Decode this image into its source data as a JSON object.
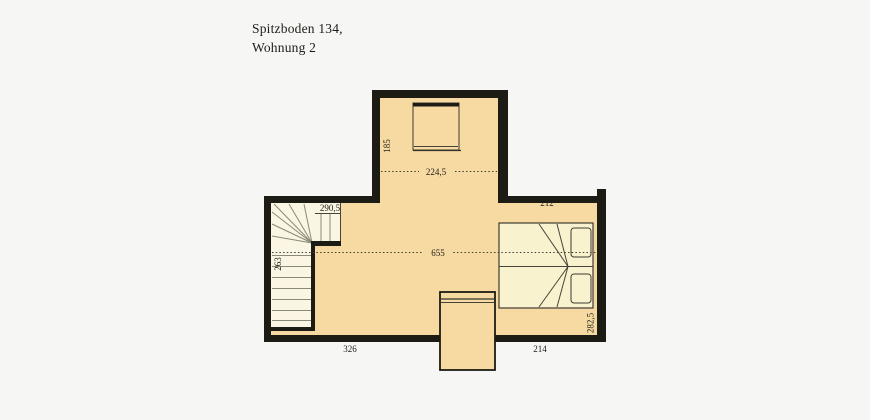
{
  "title": {
    "line1": "Spitzboden 134,",
    "line2": "Wohnung 2"
  },
  "plan": {
    "dimensions": {
      "top_width": "224,5",
      "top_height": "185",
      "stair_width": "290,5",
      "stair_height": "263",
      "room_width": "655",
      "right_room_width": "212",
      "bottom_left_width": "326",
      "bottom_right_width": "214",
      "right_height": "282,5"
    }
  },
  "colors": {
    "background": "#f6f6f5",
    "wall": "#1c1b14",
    "floor": "#f7d9a2",
    "furniture": "#f8f2cf",
    "stair": "#fbf6e3",
    "line": "#45443a",
    "text": "#1e1d16"
  }
}
